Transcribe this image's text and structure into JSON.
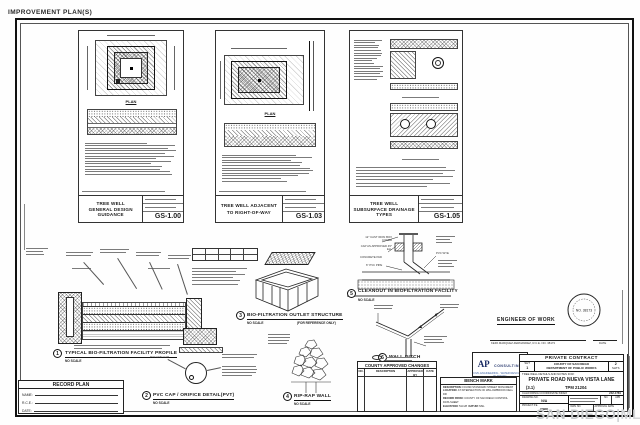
{
  "page": {
    "corner_label": "IMPROVEMENT PLAN(S)",
    "watermark_left": "SAN DIEGO",
    "watermark_sep": "|",
    "watermark_right": "MLS"
  },
  "panels": [
    {
      "title1": "TREE WELL",
      "title2": "GENERAL DESIGN GUIDANCE",
      "sheet": "GS-1.00",
      "plan_label": "PLAN"
    },
    {
      "title1": "TREE WELL ADJACENT",
      "title2": "TO RIGHT-OF-WAY",
      "sheet": "GS-1.03",
      "plan_label": "PLAN"
    },
    {
      "title1": "TREE WELL",
      "title2": "SUBSURFACE DRAINAGE TYPES",
      "sheet": "GS-1.05",
      "plan_label": ""
    }
  ],
  "details": {
    "d1": {
      "num": "1",
      "label": "TYPICAL BIO-FILTRATION FACILITY PROFILE",
      "scale": "NO SCALE"
    },
    "d2": {
      "num": "2",
      "label": "PVC CAP / ORIFICE DETAIL(PVT)",
      "scale": "NO SCALE",
      "callout_cap": "PVC END CAP"
    },
    "d3": {
      "num": "3",
      "label": "BIO-FILTRATION OUTLET STRUCTURE",
      "scale": "NO SCALE",
      "ref_note": "(FOR REFERENCE ONLY)"
    },
    "d4": {
      "num": "4",
      "label": "RIP-RAP WALL",
      "scale": "NO SCALE"
    },
    "d5": {
      "num": "5",
      "label": "CLEANOUT IN BIOFILTRATION FACILITY",
      "scale": "NO SCALE",
      "callout_cover": "12\" CAST IRON BOX COVER",
      "callout_pad": "CONCRETE PAD",
      "callout_pipe": "6\" PVC PIPE",
      "callout_wye": "PVC WYE",
      "callout_cap": "CAP AS APPROVED 45° ELL"
    },
    "d6": {
      "num": "6",
      "label": "WALL DITCH",
      "scale": "NOT TO SCALE"
    }
  },
  "record_plan": {
    "title": "RECORD PLAN",
    "name_label": "NAME:",
    "rce_label": "R.C.E.:",
    "date_label": "DATE:"
  },
  "county_changes": {
    "title": "COUNTY APPROVED CHANGES",
    "col_no": "NO.",
    "col_desc": "DESCRIPTION",
    "col_appr": "APPROVED BY",
    "col_date": "DATE"
  },
  "bench_mark": {
    "title": "BENCH MARK",
    "desc_label": "DESCRIPTION:",
    "desc_value": "FOUND STANDARD STREET MONUMENT",
    "loc_label": "LOCATION:",
    "loc_value": "AT INTERSECTION OF WILLOWBROOK DELL DR",
    "rec_label": "RECORD FROM:",
    "rec_value": "COUNTY OF SAN DIEGO CONTROL DATA SHEET",
    "elev_label": "ELEVATION:",
    "elev_value": "513.28",
    "datum_label": "DATUM:",
    "datum_value": "MSL"
  },
  "engineer": {
    "heading": "ENGINEER OF WORK",
    "signature": "KEPA MARQUEZ-FERNANDEZ, R.C.E. NO. 38173",
    "date_label": "DATE",
    "seal_no": "NO. 38173"
  },
  "ap": {
    "initials": "AP",
    "word": "CONSULTING",
    "tagline": "CIVIL ENGINEERING · WATER RESOURCES PLANNING"
  },
  "contract": {
    "header": "PRIVATE CONTRACT",
    "sht_label": "SHT",
    "sht_no": "1",
    "agency1": "COUNTY OF SAN DIEGO",
    "agency2": "DEPARTMENT OF PUBLIC WORKS",
    "of_no": "2",
    "shts_label": "SHTS",
    "for_line": "TREE WELL DETAILS AND NOTES FOR:",
    "road": "PRIVATE ROAD NUEVA VISTA LANE",
    "parcel": "(3.1)",
    "tpm": "TPM 21204",
    "coord_label": "CALIFORNIA COORDINATE INDEX",
    "coord_value": "242-1781",
    "g1_label": "DRAWING NO.",
    "g1_value": "N/A",
    "g2_label": "PROJECT P.E.",
    "g2_value": "(TBD)",
    "g3_no": "NO.",
    "g3_apr": "APR",
    "g4_dwg": "DWG NO.",
    "g4_date": "APPROVAL DATE"
  }
}
